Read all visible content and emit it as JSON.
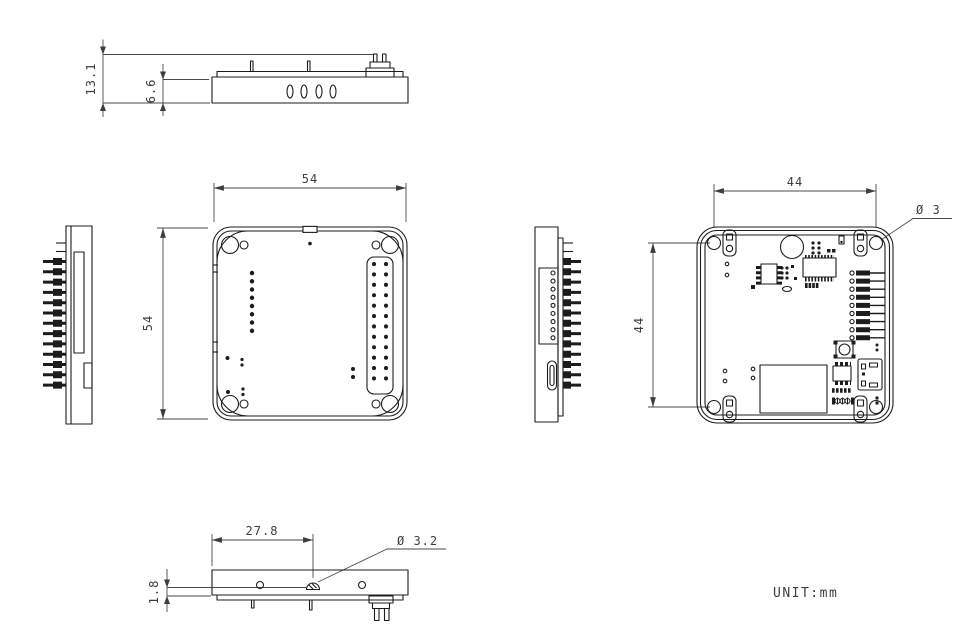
{
  "drawing": {
    "unit_label": "UNIT:mm",
    "line_color": "#1c1c1c",
    "dim_color": "#3d3d3d",
    "background": "#ffffff",
    "dims": {
      "total_height": "13.1",
      "body_height": "6.6",
      "top_width": "54",
      "top_depth": "54",
      "hole_pitch_h": "44",
      "hole_pitch_v": "44",
      "corner_hole_dia": "Ø 3",
      "base_hole_offset": "27.8",
      "base_plate_height": "1.8",
      "base_hole_dia": "Ø 3.2"
    }
  }
}
